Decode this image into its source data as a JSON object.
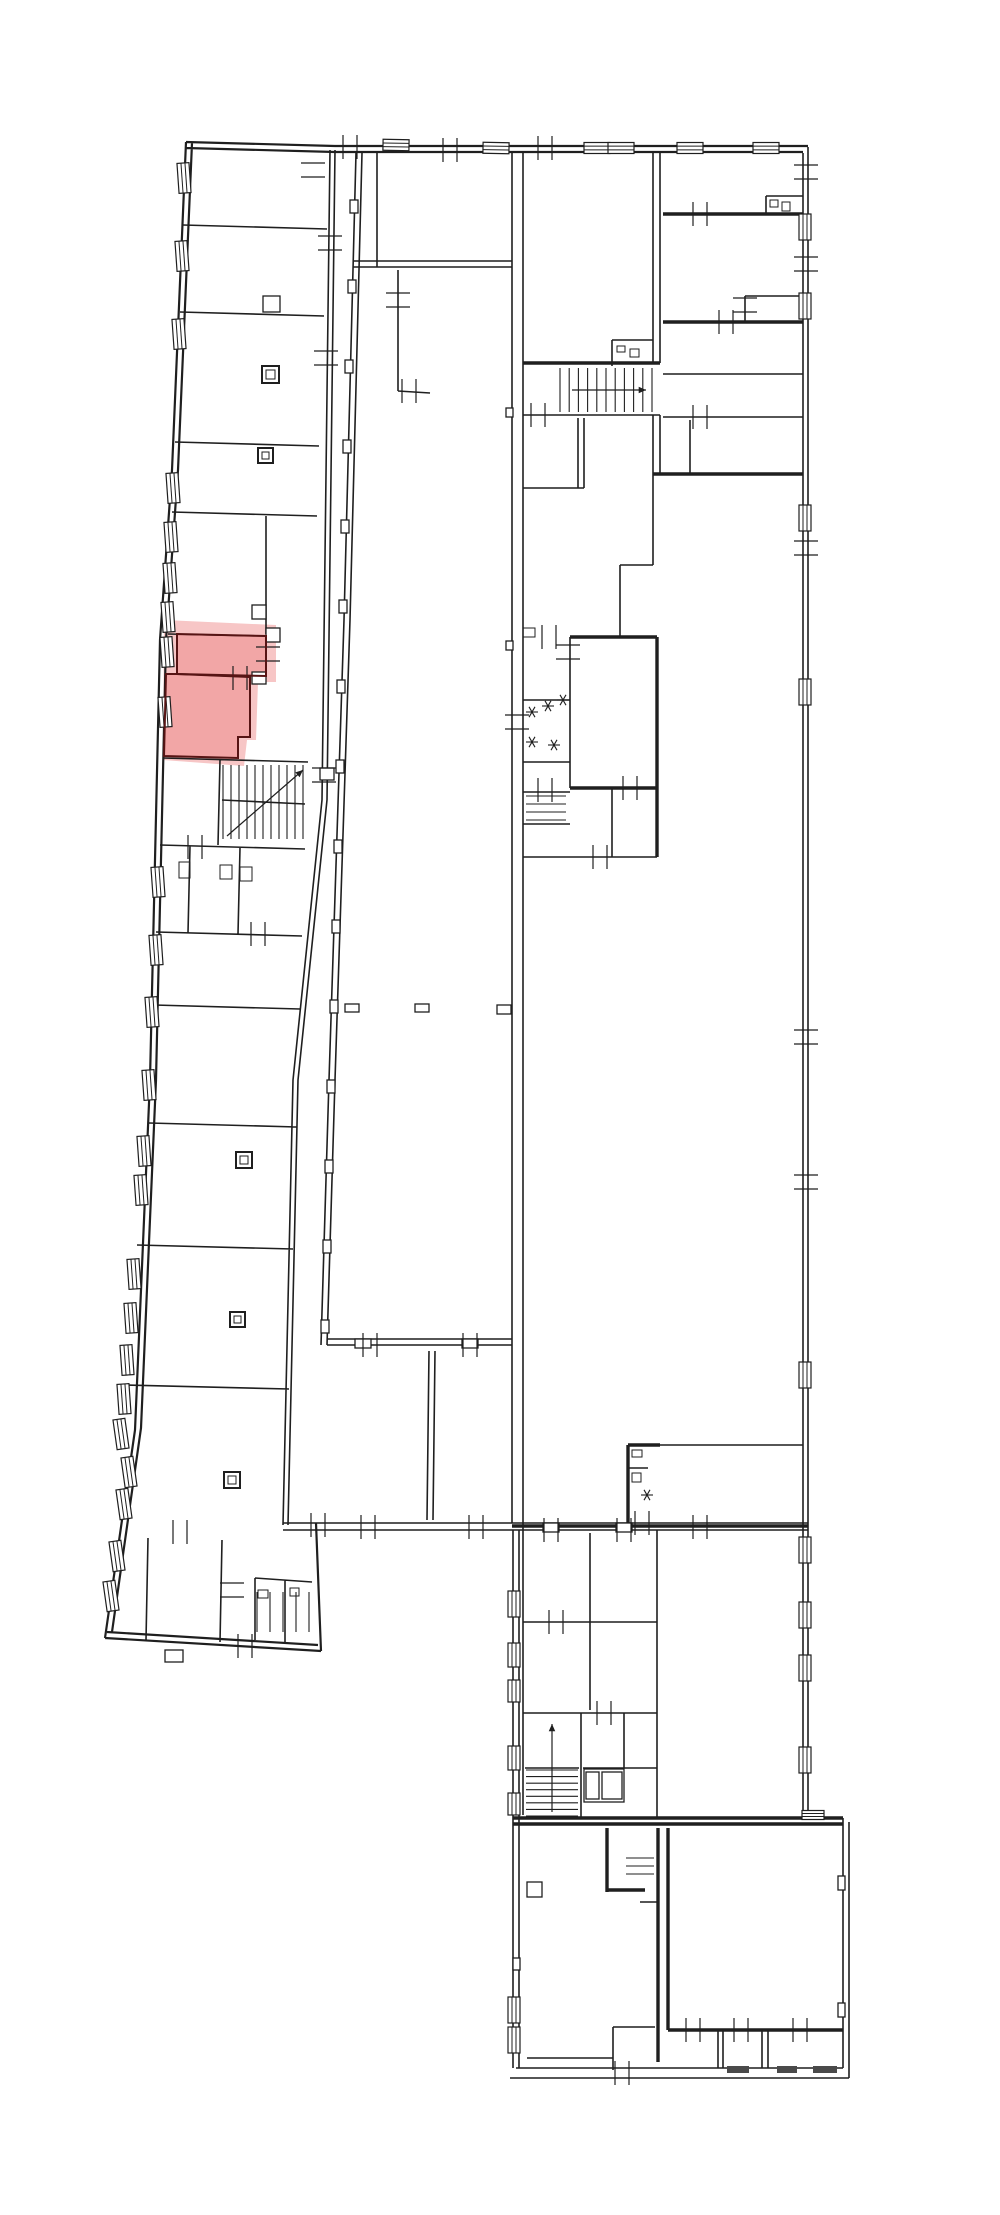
{
  "meta": {
    "type": "floor-plan-drawing",
    "background": "#ffffff",
    "wall_color": "#1f1f1f",
    "highlight_halo_color": "#f7c6c6",
    "highlight_room_color": "#f2a6a6",
    "highlight_outline_color": "#571414",
    "dark_bar_color": "#4a4a4a"
  },
  "floorplan": {
    "canvas": {
      "w": 1000,
      "h": 2215
    },
    "highlight": {
      "halo": "M164,620 L276,625 L276,682 L258,682 L256,740 L247,740 L244,766 L163,760 Z",
      "rooms": [
        "M177,634 L266,636 L266,676 L177,674 Z",
        "M177,674 L250,677 L250,737 L238,737 L238,758 L164,756 L166,674 Z"
      ]
    },
    "outer_paths": "M186,142 L172,470 L160,640 L150,1080 L135,1430 L105,1638 M192,143 L178,470 L166,640 L156,1080 L141,1428 L112,1632 M105,1638 L321,1651 M107,1632 L318,1645 M321,1651 L316,1523 M186,142 L335,146 L808,146 M186,148 L335,152 L803,152",
    "thin_paths": "M183,225 L327,229 M180,312 L324,316 M175,442 L319,446 M172,512 L317,516 M168,634 L266,636 M177,674 L250,677 M163,758 L308,762 M160,845 L305,849 M156,932 L302,936 M154,1005 L300,1009 M149,1123 L297,1127 M137,1245 L293,1249 M126,1385 L289,1389 M190,846 L188,933 M240,848 L238,934 M266,516 L266,634 M250,677 L250,737 M238,737 L250,737 M238,737 L238,758 M220,760 L218,845 M222,800 L305,804 M148,1538 L146,1640 M222,1540 L220,1642 M255,1578 L312,1582 M255,1578 L255,1640 M285,1580 L285,1642 M330,150 L322,800 L293,1080 L283,1525 M335,150 L327,800 L298,1080 L288,1525 M362,153 L350,620 L335,1080 L327,1345 M356,153 L344,620 L329,1080 L321,1345 M377,153 L377,267 M398,270 L398,391 M398,391 L430,393 M353,261 L512,261 M353,267 L512,267 M327,1339 L512,1339 M327,1345 L512,1345 M429,1351 L427,1520 M435,1351 L433,1520 M283,1523 L808,1523 M283,1530 L808,1530 M512,153 L512,1523 M523,153 L523,1815 M513,1530 L513,2068 M519,1530 L519,2068 M803,153 L803,1818 M808,147 L808,1820 M653,153 L653,363 M660,153 L660,363 M653,415 L653,474 M660,415 L660,474 M523,415 L660,415 M578,418 L578,488 M584,418 L584,488 M523,488 L584,488 M620,565 L620,637 M620,565 L653,565 M653,474 L653,565 M663,374 L803,374 M663,417 L803,417 M690,420 L690,474 M745,296 L745,322 M745,296 L803,296 M766,196 L766,214 M766,196 L803,196 M523,700 L570,700 M523,762 L570,762 M523,792 L570,792 M523,824 L570,824 M612,788 L612,857 M523,857 L657,857 M570,637 L570,788 M612,340 L653,340 M612,340 L612,366 M628,1468 L648,1468 M660,1445 L803,1445 M590,1533 L590,1710 M523,1622 L657,1622 M523,1713 L657,1713 M657,1530 L657,1818 M581,1713 L581,1818 M583,1768 L657,1768 M624,1713 L624,1768 M525,1768 L579,1768 M527,2058 L613,2058 M613,2027 L655,2027 M613,2027 L613,2062 M640,1902 L658,1902 M613,2062 L613,2070 M718,2030 L718,2068 M723,2030 L723,2068 M762,2030 L762,2068 M768,2030 L768,2068 M843,1818 L843,2068 M849,1822 L849,2078 M516,2068 L843,2068 M510,2078 L849,2078",
    "thick_paths": "M523,363 L660,363 M663,214 L803,214 M663,322 L803,322 M653,474 L803,474 M570,637 L657,637 M657,637 L657,857 M570,788 L657,788 M628,1445 L628,1523 M628,1445 L660,1445 M512,1526 L808,1526 M513,1818 L843,1818 M513,1824 L843,1824 M658,1828 L658,2062 M668,1828 L668,2030 M668,2030 L843,2030 M607,1828 L607,1892 M607,1890 L645,1890",
    "extra_lines": [
      [
        602,
        1772,
        622,
        1799
      ],
      [
        622,
        1772,
        602,
        1799
      ],
      [
        527,
        1897,
        542,
        1882
      ]
    ],
    "arrows": [
      [
        572,
        390,
        646,
        390
      ],
      [
        227,
        836,
        303,
        770
      ],
      [
        552,
        1812,
        552,
        1724
      ]
    ],
    "windows": [
      [
        184,
        178,
        12,
        30,
        -4
      ],
      [
        182,
        256,
        12,
        30,
        -4
      ],
      [
        179,
        334,
        12,
        30,
        -4
      ],
      [
        173,
        488,
        12,
        30,
        -4
      ],
      [
        171,
        537,
        12,
        30,
        -4
      ],
      [
        170,
        578,
        12,
        30,
        -4
      ],
      [
        168,
        617,
        12,
        30,
        -4
      ],
      [
        167,
        652,
        12,
        30,
        -4
      ],
      [
        165,
        712,
        12,
        30,
        -4
      ],
      [
        158,
        882,
        12,
        30,
        -4
      ],
      [
        156,
        950,
        12,
        30,
        -4
      ],
      [
        152,
        1012,
        12,
        30,
        -4
      ],
      [
        149,
        1085,
        12,
        30,
        -4
      ],
      [
        144,
        1151,
        12,
        30,
        -4
      ],
      [
        141,
        1190,
        12,
        30,
        -4
      ],
      [
        134,
        1274,
        12,
        30,
        -4
      ],
      [
        131,
        1318,
        12,
        30,
        -4
      ],
      [
        127,
        1360,
        12,
        30,
        -4
      ],
      [
        124,
        1399,
        12,
        30,
        -4
      ],
      [
        121,
        1434,
        12,
        30,
        -8
      ],
      [
        129,
        1472,
        12,
        30,
        -8
      ],
      [
        124,
        1504,
        12,
        30,
        -8
      ],
      [
        117,
        1556,
        12,
        30,
        -8
      ],
      [
        111,
        1596,
        12,
        30,
        -8
      ],
      [
        396,
        145,
        26,
        11,
        1
      ],
      [
        496,
        148,
        26,
        11,
        1
      ],
      [
        597,
        148,
        26,
        11,
        0
      ],
      [
        621,
        148,
        26,
        11,
        0
      ],
      [
        690,
        148,
        26,
        11,
        0
      ],
      [
        766,
        148,
        26,
        11,
        0
      ],
      [
        805,
        227,
        12,
        26,
        0
      ],
      [
        805,
        306,
        12,
        26,
        0
      ],
      [
        805,
        518,
        12,
        26,
        0
      ],
      [
        805,
        692,
        12,
        26,
        0
      ],
      [
        805,
        1375,
        12,
        26,
        0
      ],
      [
        805,
        1550,
        12,
        26,
        0
      ],
      [
        805,
        1615,
        12,
        26,
        0
      ],
      [
        805,
        1668,
        12,
        26,
        0
      ],
      [
        805,
        1760,
        12,
        26,
        0
      ],
      [
        514,
        1604,
        12,
        26,
        0
      ],
      [
        514,
        1655,
        12,
        24,
        0
      ],
      [
        514,
        1691,
        12,
        22,
        0
      ],
      [
        514,
        1758,
        12,
        24,
        0
      ],
      [
        514,
        1804,
        12,
        22,
        0
      ],
      [
        514,
        2010,
        12,
        26,
        0
      ],
      [
        514,
        2040,
        12,
        26,
        0
      ],
      [
        813,
        1815,
        22,
        9,
        0
      ]
    ],
    "ticks": [
      [
        350,
        147,
        "h"
      ],
      [
        450,
        150,
        "h"
      ],
      [
        545,
        148,
        "h"
      ],
      [
        409,
        391,
        "h"
      ],
      [
        538,
        415,
        "h"
      ],
      [
        313,
        170,
        "v"
      ],
      [
        330,
        243,
        "v"
      ],
      [
        326,
        358,
        "v"
      ],
      [
        268,
        654,
        "v"
      ],
      [
        240,
        678,
        "h"
      ],
      [
        324,
        775,
        "v"
      ],
      [
        195,
        847,
        "h"
      ],
      [
        258,
        934,
        "h"
      ],
      [
        398,
        300,
        "v"
      ],
      [
        806,
        172,
        "v"
      ],
      [
        806,
        264,
        "v"
      ],
      [
        806,
        548,
        "v"
      ],
      [
        806,
        1037,
        "v"
      ],
      [
        806,
        1182,
        "v"
      ],
      [
        370,
        1345,
        "h"
      ],
      [
        470,
        1345,
        "h"
      ],
      [
        368,
        1527,
        "h"
      ],
      [
        476,
        1527,
        "h"
      ],
      [
        318,
        1525,
        "h"
      ],
      [
        549,
        637,
        "h"
      ],
      [
        568,
        652,
        "v"
      ],
      [
        545,
        790,
        "h"
      ],
      [
        630,
        788,
        "h"
      ],
      [
        600,
        857,
        "h"
      ],
      [
        517,
        722,
        "v"
      ],
      [
        700,
        214,
        "h"
      ],
      [
        726,
        322,
        "h"
      ],
      [
        745,
        305,
        "v"
      ],
      [
        700,
        417,
        "h"
      ],
      [
        642,
        1523,
        "h"
      ],
      [
        551,
        1530,
        "h"
      ],
      [
        624,
        1530,
        "h"
      ],
      [
        700,
        1527,
        "h"
      ],
      [
        556,
        1622,
        "h"
      ],
      [
        604,
        1713,
        "h"
      ],
      [
        622,
        2073,
        "h"
      ],
      [
        693,
        2030,
        "h"
      ],
      [
        741,
        2030,
        "h"
      ],
      [
        800,
        2030,
        "h"
      ],
      [
        245,
        1646,
        "h"
      ],
      [
        232,
        1590,
        "v"
      ],
      [
        180,
        1532,
        "h"
      ]
    ],
    "stars": [
      [
        532,
        712
      ],
      [
        548,
        706
      ],
      [
        563,
        700
      ],
      [
        532,
        742
      ],
      [
        554,
        745
      ],
      [
        647,
        1495
      ]
    ],
    "squares": [
      [
        262,
        366,
        17
      ],
      [
        258,
        448,
        15
      ],
      [
        236,
        1152,
        16
      ],
      [
        230,
        1312,
        15
      ],
      [
        224,
        1472,
        16
      ]
    ],
    "bumps": [
      [
        263,
        296,
        17,
        16
      ],
      [
        266,
        628,
        14,
        14
      ],
      [
        252,
        605,
        14,
        14
      ],
      [
        252,
        672,
        14,
        12
      ],
      [
        320,
        768,
        14,
        12
      ],
      [
        543,
        1523,
        16,
        9
      ],
      [
        616,
        1523,
        16,
        9
      ],
      [
        355,
        1339,
        16,
        9
      ],
      [
        462,
        1339,
        16,
        9
      ],
      [
        165,
        1650,
        18,
        12
      ],
      [
        345,
        1004,
        14,
        8
      ],
      [
        415,
        1004,
        14,
        8
      ],
      [
        497,
        1005,
        14,
        9
      ],
      [
        506,
        408,
        7,
        9
      ],
      [
        506,
        641,
        7,
        9
      ],
      [
        513,
        1958,
        7,
        12
      ],
      [
        838,
        1876,
        7,
        14
      ],
      [
        838,
        2003,
        7,
        14
      ],
      [
        527,
        1882,
        15,
        15
      ],
      [
        584,
        1769,
        40,
        33
      ],
      [
        602,
        1772,
        20,
        27
      ],
      [
        586,
        1772,
        13,
        27
      ],
      [
        350,
        200,
        8,
        13
      ],
      [
        348,
        280,
        8,
        13
      ],
      [
        345,
        360,
        8,
        13
      ],
      [
        343,
        440,
        8,
        13
      ],
      [
        341,
        520,
        8,
        13
      ],
      [
        339,
        600,
        8,
        13
      ],
      [
        337,
        680,
        8,
        13
      ],
      [
        336,
        760,
        8,
        13
      ],
      [
        334,
        840,
        8,
        13
      ],
      [
        332,
        920,
        8,
        13
      ],
      [
        330,
        1000,
        8,
        13
      ],
      [
        327,
        1080,
        8,
        13
      ],
      [
        325,
        1160,
        8,
        13
      ],
      [
        323,
        1240,
        8,
        13
      ],
      [
        321,
        1320,
        8,
        13
      ]
    ],
    "fixtures": [
      [
        179,
        862,
        11,
        16
      ],
      [
        220,
        865,
        12,
        14
      ],
      [
        240,
        867,
        12,
        14
      ],
      [
        617,
        346,
        8,
        6
      ],
      [
        630,
        349,
        9,
        8
      ],
      [
        770,
        200,
        8,
        7
      ],
      [
        782,
        202,
        8,
        9
      ],
      [
        632,
        1450,
        10,
        7
      ],
      [
        632,
        1473,
        9,
        9
      ],
      [
        258,
        1590,
        10,
        8
      ],
      [
        290,
        1588,
        9,
        8
      ],
      [
        523,
        628,
        12,
        9
      ]
    ],
    "hatches": [
      [
        560,
        368,
        92,
        44,
        11,
        "v"
      ],
      [
        223,
        765,
        80,
        74,
        11,
        "v"
      ],
      [
        526,
        1770,
        52,
        46,
        8,
        "h"
      ],
      [
        586,
        1772,
        13,
        27,
        4,
        "h"
      ],
      [
        526,
        796,
        40,
        24,
        4,
        "h"
      ],
      [
        626,
        1858,
        28,
        16,
        3,
        "h"
      ],
      [
        257,
        1592,
        52,
        40,
        5,
        "v"
      ]
    ],
    "darkbars": [
      [
        727,
        2066,
        22,
        7
      ],
      [
        777,
        2066,
        20,
        7
      ],
      [
        813,
        2066,
        24,
        7
      ]
    ]
  }
}
